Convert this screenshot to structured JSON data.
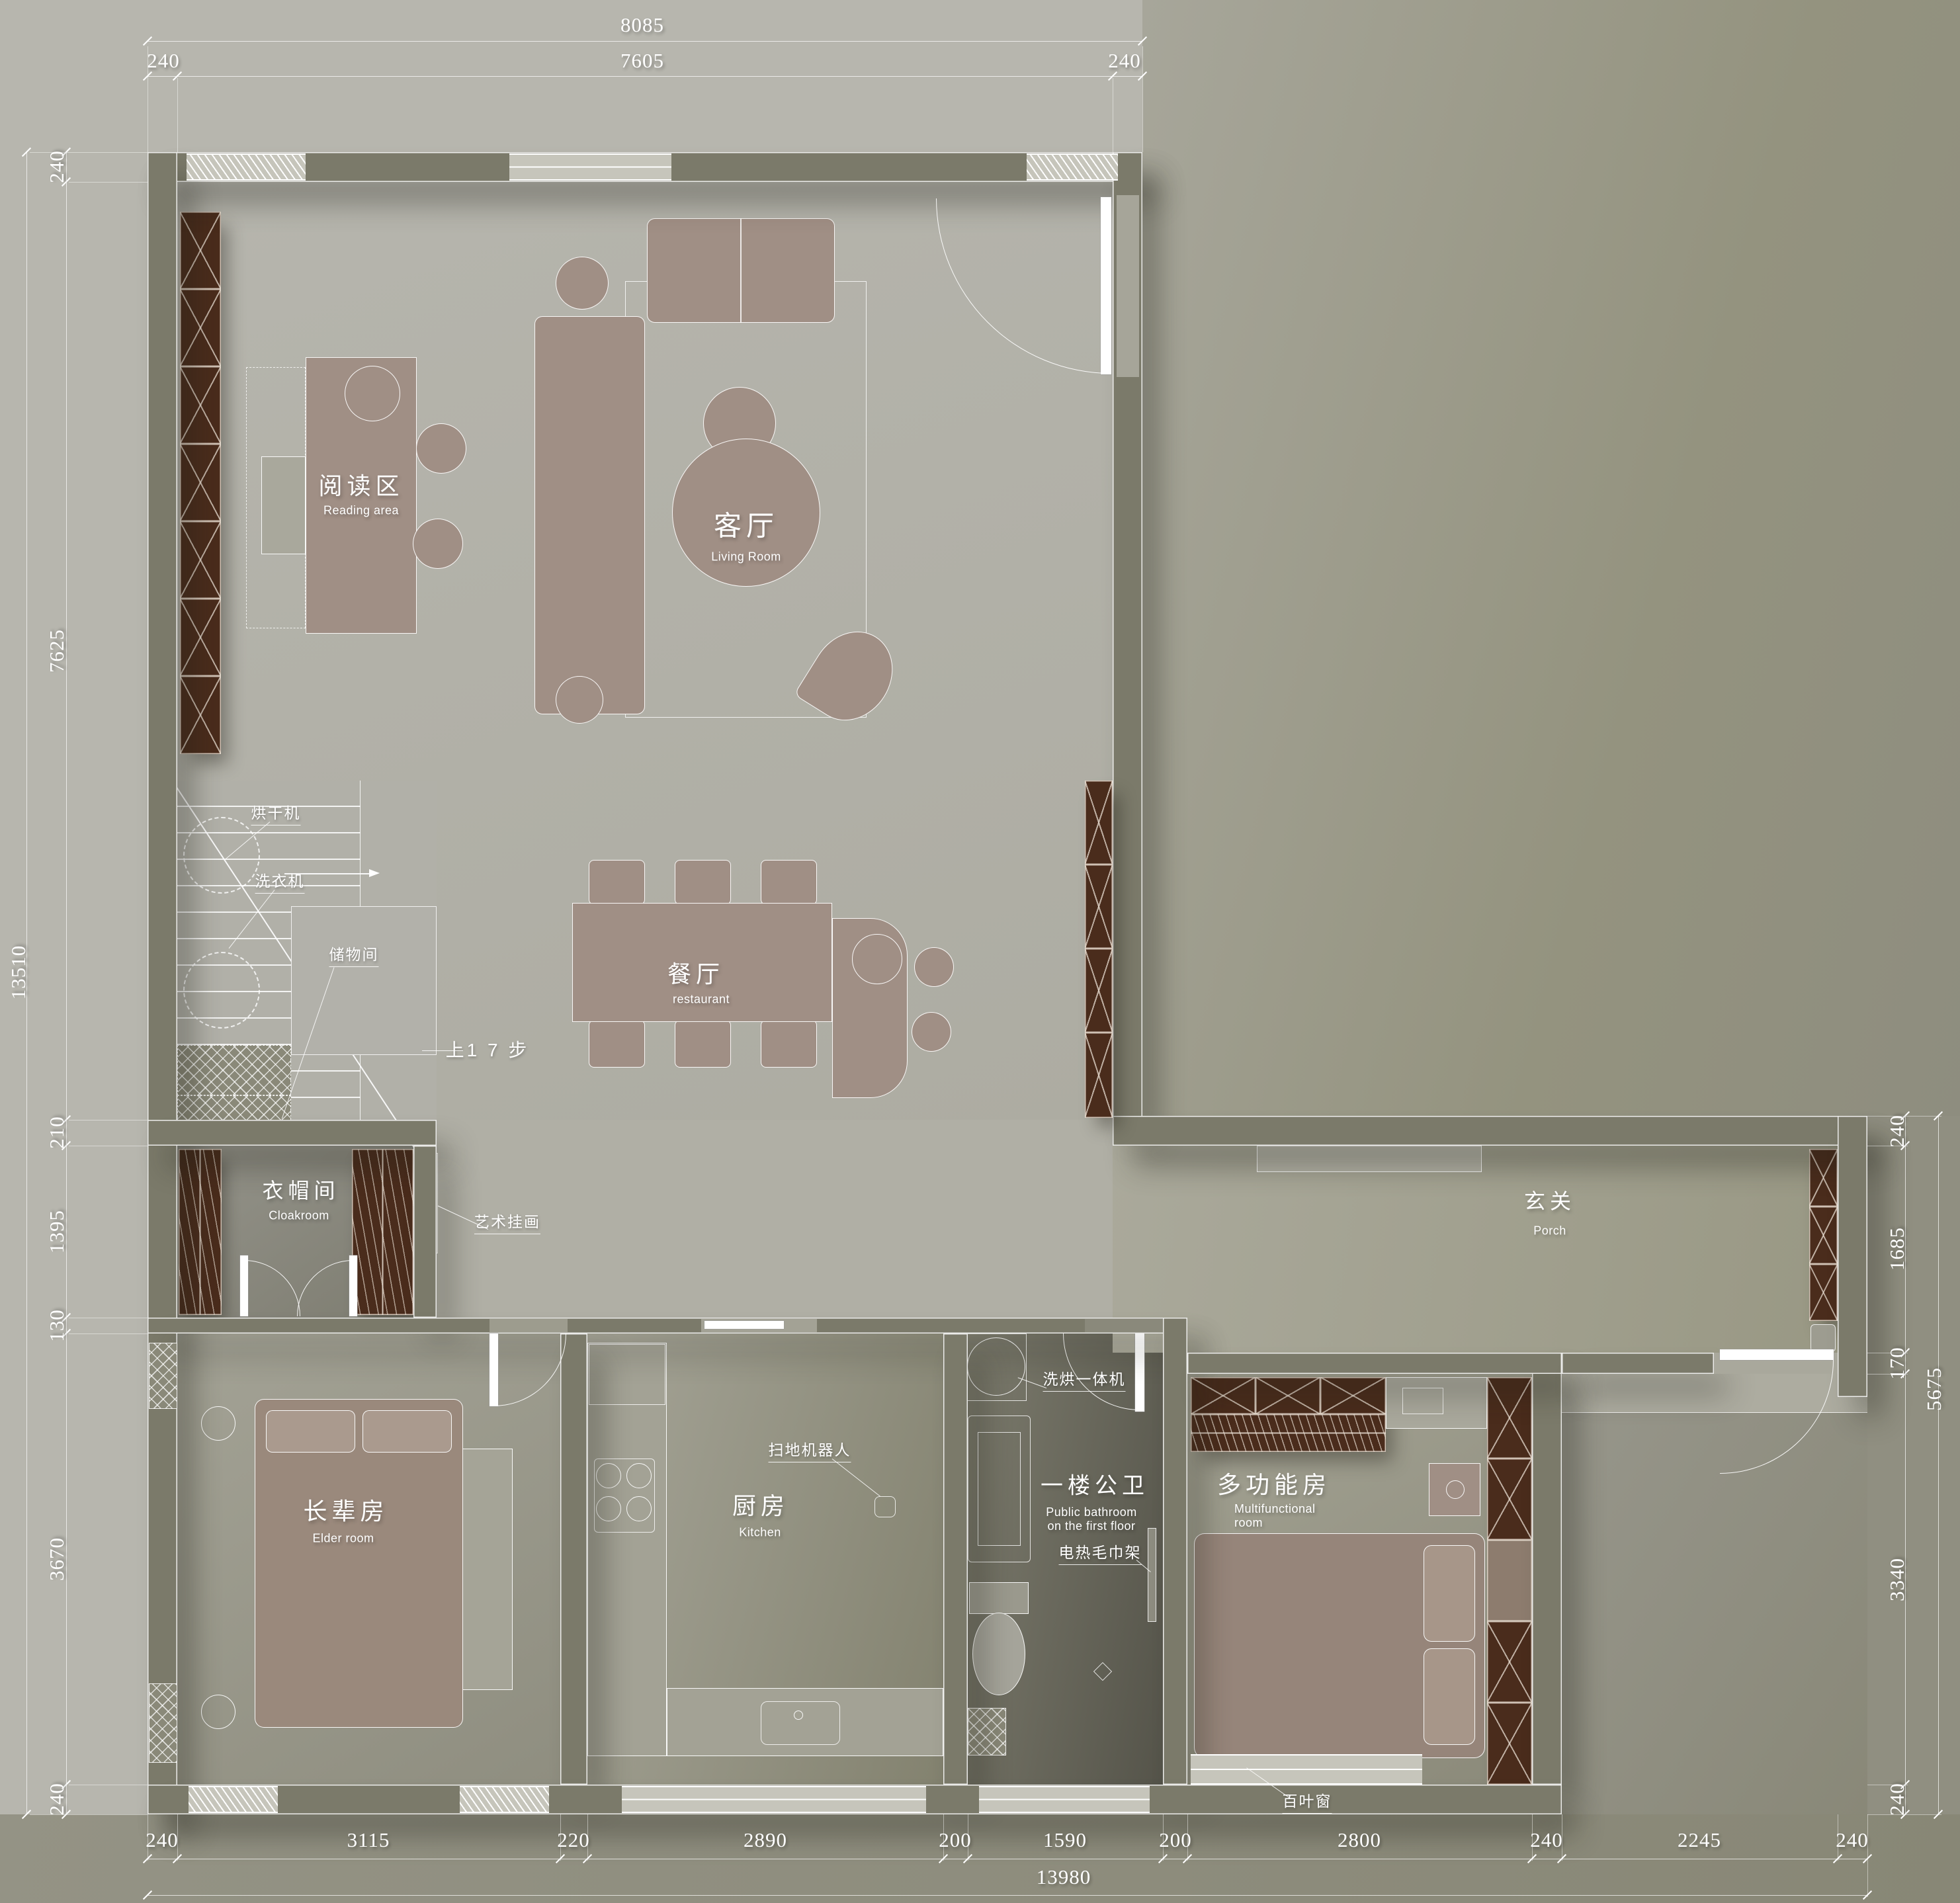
{
  "drawing": {
    "rooms": {
      "reading": {
        "cn": "阅读区",
        "en": "Reading area"
      },
      "living": {
        "cn": "客厅",
        "en": "Living Room"
      },
      "dining": {
        "cn": "餐厅",
        "en": "restaurant"
      },
      "cloakroom": {
        "cn": "衣帽间",
        "en": "Cloakroom"
      },
      "porch": {
        "cn": "玄关",
        "en": "Porch"
      },
      "elder": {
        "cn": "长辈房",
        "en": "Elder room"
      },
      "kitchen": {
        "cn": "厨房",
        "en": "Kitchen"
      },
      "bathroom": {
        "cn": "一楼公卫",
        "en": "Public bathroom\non the first floor"
      },
      "multi": {
        "cn": "多功能房",
        "en": "Multifunctional\nroom"
      }
    },
    "annotations": {
      "dryer": "烘干机",
      "washer": "洗衣机",
      "storage": "储物间",
      "stairs_note": "上1 7 步",
      "art": "艺术挂画",
      "robot": "扫地机器人",
      "washer_dryer": "洗烘一体机",
      "towel_rack": "电热毛巾架",
      "blinds": "百叶窗"
    },
    "dimensions": {
      "top_total": "8085",
      "top_chain": [
        "240",
        "7605",
        "240"
      ],
      "left_total": "13510",
      "left_chain": [
        "240",
        "7625",
        "210",
        "1395",
        "130",
        "3670",
        "240"
      ],
      "right_total": "5675",
      "right_chain": [
        "240",
        "1685",
        "170",
        "3340",
        "240"
      ],
      "bottom_total": "13980",
      "bottom_chain": [
        "240",
        "3115",
        "220",
        "2890",
        "200",
        "1590",
        "200",
        "2800",
        "240",
        "2245",
        "240"
      ]
    },
    "colors": {
      "wall": "#7b7a6a",
      "floor": "#b2b1a9",
      "furniture": "#a08f85",
      "cabinet_dark": "#4a2c1c",
      "background_light": "#b7b6ae",
      "background_dark": "#8e8d7f",
      "text": "#ffffff"
    }
  }
}
